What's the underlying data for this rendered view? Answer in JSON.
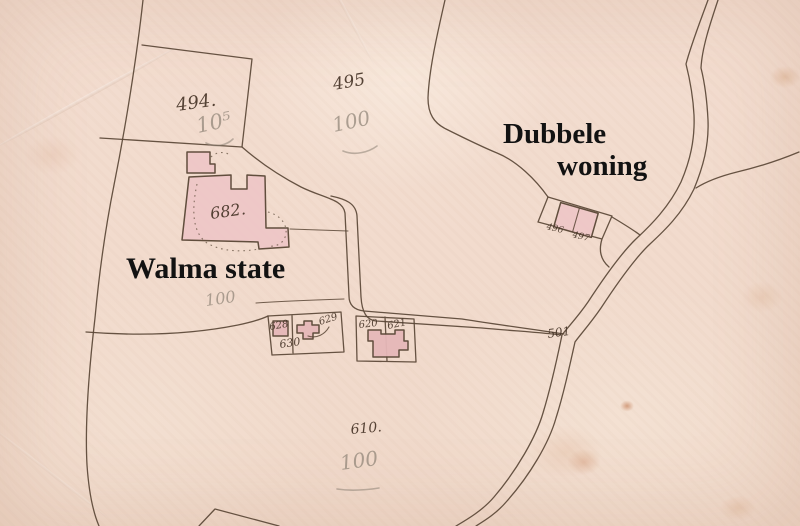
{
  "colors": {
    "paper": "#f2dccd",
    "ink": "#5a4736",
    "ink_text": "#473528",
    "building_fill": "#eec7c7",
    "building_fill_dark": "#e6b8b9",
    "pencil": "#8d8275",
    "label": "#121212"
  },
  "labels": {
    "walma": "Walma state",
    "dubbele_line1": "Dubbele",
    "dubbele_line2": "woning"
  },
  "ink_numbers": {
    "n494": "494.",
    "n495": "495",
    "n682": "682.",
    "n610": "610.",
    "n501": "501",
    "n628": "628",
    "n629": "629",
    "n630": "630",
    "n620": "620",
    "n621": "621",
    "n496": "496",
    "n497": "497"
  },
  "pencil_numbers": {
    "p494": "10⁵",
    "p495": "100",
    "pwalma": "100",
    "p610": "100"
  }
}
